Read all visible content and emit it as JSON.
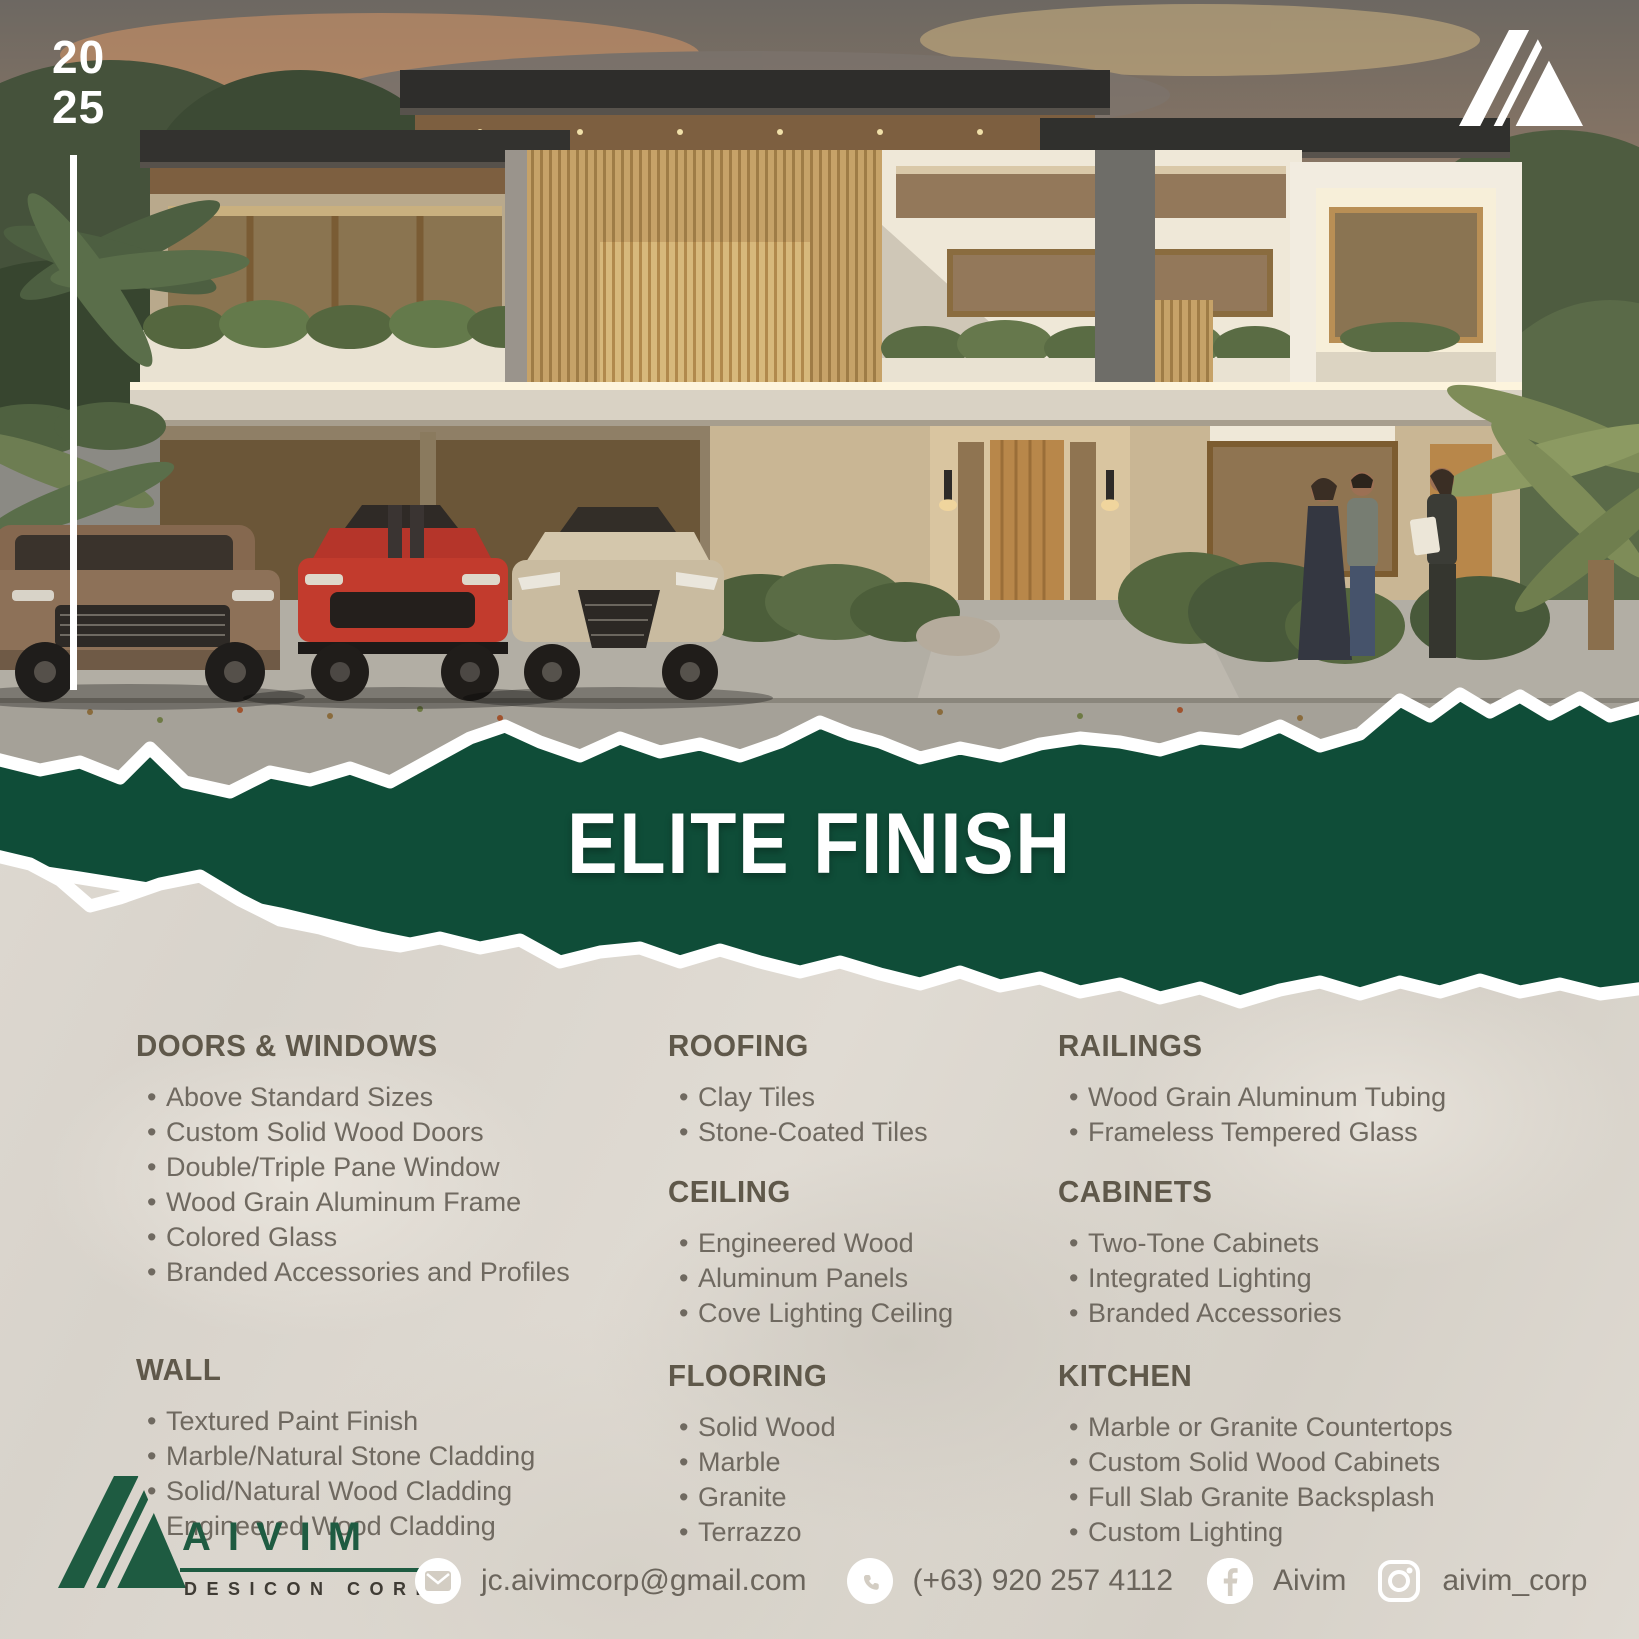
{
  "hero": {
    "year_line1": "20",
    "year_line2": "25"
  },
  "band": {
    "title": "ELITE FINISH"
  },
  "specs": {
    "columns": [
      {
        "sections": [
          {
            "title": "DOORS & WINDOWS",
            "items": [
              "Above Standard Sizes",
              "Custom Solid Wood Doors",
              "Double/Triple Pane Window",
              "Wood Grain Aluminum Frame",
              "Colored Glass",
              "Branded Accessories and Profiles"
            ]
          },
          {
            "title": "WALL",
            "items": [
              "Textured Paint Finish",
              "Marble/Natural Stone Cladding",
              "Solid/Natural Wood Cladding",
              "Engineered Wood Cladding"
            ]
          }
        ]
      },
      {
        "sections": [
          {
            "title": "ROOFING",
            "items": [
              "Clay Tiles",
              "Stone-Coated Tiles"
            ]
          },
          {
            "title": "CEILING",
            "items": [
              "Engineered Wood",
              "Aluminum Panels",
              "Cove Lighting Ceiling"
            ]
          },
          {
            "title": "FLOORING",
            "items": [
              "Solid Wood",
              "Marble",
              "Granite",
              "Terrazzo"
            ]
          }
        ]
      },
      {
        "sections": [
          {
            "title": "RAILINGS",
            "items": [
              "Wood Grain Aluminum Tubing",
              "Frameless Tempered Glass"
            ]
          },
          {
            "title": "CABINETS",
            "items": [
              "Two-Tone Cabinets",
              "Integrated Lighting",
              "Branded Accessories"
            ]
          },
          {
            "title": "KITCHEN",
            "items": [
              "Marble or Granite Countertops",
              "Custom Solid Wood Cabinets",
              "Full Slab Granite Backsplash",
              "Custom Lighting"
            ]
          }
        ]
      }
    ]
  },
  "footer": {
    "brand_name": "AIVIM",
    "brand_sub": "DESICON CORP",
    "email": "jc.aivimcorp@gmail.com",
    "phone": "(+63) 920 257 4112",
    "facebook": "Aivim",
    "instagram": "aivim_corp"
  },
  "icons": {
    "top_logo": "a-mark-icon",
    "email": "envelope-icon",
    "phone": "phone-icon",
    "facebook": "facebook-icon",
    "instagram": "instagram-icon"
  },
  "colors": {
    "band_green": "#0F4D38",
    "logo_green": "#1E5B41",
    "paper": "#DCD7CF",
    "heading_text": "#5F584A",
    "body_text": "#6F6960"
  }
}
